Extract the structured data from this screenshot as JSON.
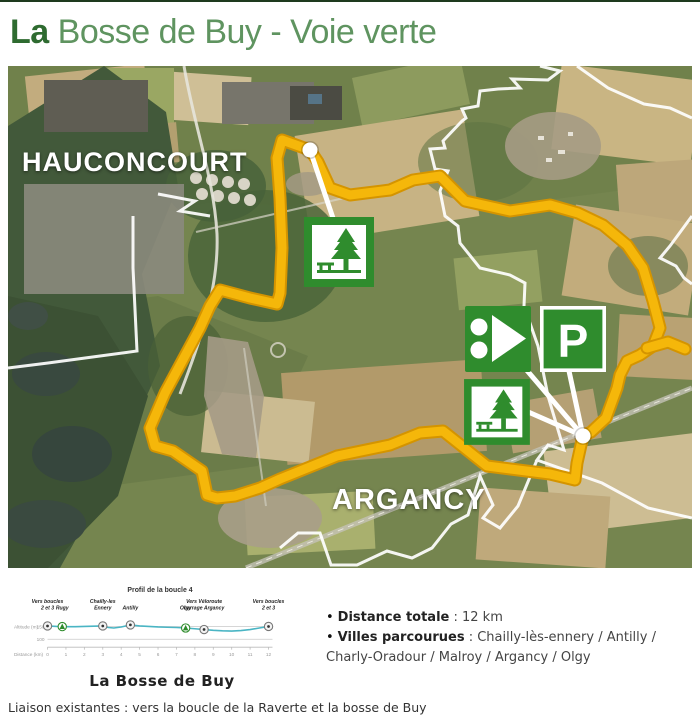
{
  "header": {
    "title_prefix": "La",
    "title_rest": "Bosse de Buy - Voie verte"
  },
  "map": {
    "place_labels": {
      "hauconcourt": "HAUCONCOURT",
      "argancy": "ARGANCY"
    },
    "icons": {
      "parking_label": "P"
    },
    "route": {
      "color": "#f5b70a",
      "casing_color": "#d49400",
      "points": [
        [
          302,
          84
        ],
        [
          310,
          96
        ],
        [
          322,
          122
        ],
        [
          342,
          129
        ],
        [
          382,
          124
        ],
        [
          405,
          114
        ],
        [
          432,
          110
        ],
        [
          457,
          135
        ],
        [
          502,
          145
        ],
        [
          542,
          139
        ],
        [
          570,
          147
        ],
        [
          595,
          159
        ],
        [
          619,
          179
        ],
        [
          635,
          202
        ],
        [
          645,
          235
        ],
        [
          652,
          262
        ],
        [
          645,
          280
        ],
        [
          632,
          289
        ],
        [
          619,
          295
        ],
        [
          612,
          309
        ],
        [
          609,
          322
        ],
        [
          598,
          352
        ],
        [
          583,
          366
        ],
        [
          575,
          370
        ],
        [
          569,
          397
        ],
        [
          567,
          414
        ],
        [
          542,
          408
        ],
        [
          479,
          400
        ],
        [
          435,
          365
        ],
        [
          412,
          367
        ],
        [
          382,
          379
        ],
        [
          329,
          390
        ],
        [
          272,
          413
        ],
        [
          252,
          422
        ],
        [
          227,
          430
        ],
        [
          209,
          432
        ],
        [
          199,
          429
        ],
        [
          194,
          405
        ],
        [
          165,
          385
        ],
        [
          147,
          380
        ],
        [
          142,
          362
        ],
        [
          157,
          327
        ],
        [
          192,
          262
        ],
        [
          202,
          240
        ],
        [
          212,
          224
        ],
        [
          242,
          232
        ],
        [
          269,
          238
        ],
        [
          272,
          227
        ],
        [
          274,
          182
        ],
        [
          272,
          132
        ],
        [
          269,
          92
        ],
        [
          274,
          74
        ],
        [
          302,
          84
        ]
      ],
      "branch": [
        [
          639,
          282
        ],
        [
          660,
          276
        ],
        [
          677,
          283
        ]
      ],
      "markers": [
        [
          302,
          84
        ],
        [
          575,
          370
        ]
      ],
      "leaders": [
        [
          [
            302,
            84
          ],
          [
            327,
            158
          ]
        ],
        [
          [
            575,
            370
          ],
          [
            516,
            301
          ]
        ],
        [
          [
            575,
            370
          ],
          [
            561,
            305
          ]
        ],
        [
          [
            575,
            370
          ],
          [
            518,
            345
          ]
        ]
      ]
    }
  },
  "chart_data": {
    "type": "line",
    "title": "Profil de la boucle 4",
    "caption": "La Bosse de Buy",
    "xlabel": "Distance (km)",
    "ylabel": "Altitude (m)",
    "xlim": [
      0,
      12
    ],
    "xticks": [
      0,
      1,
      2,
      3,
      4,
      5,
      6,
      7,
      8,
      9,
      10,
      11,
      12
    ],
    "yticks": [
      100,
      150
    ],
    "line_color": "#4ab5c4",
    "x": [
      0,
      0.5,
      1,
      1.5,
      2,
      2.5,
      3,
      3.3,
      3.6,
      4,
      4.5,
      5,
      5.5,
      6,
      6.5,
      7,
      7.5,
      8,
      8.5,
      9,
      9.5,
      10,
      10.5,
      11,
      11.5,
      12
    ],
    "y": [
      152,
      150,
      149,
      149,
      150,
      151,
      152,
      146,
      144,
      148,
      156,
      152,
      150,
      148,
      147,
      146,
      144,
      141,
      138,
      135,
      133,
      132,
      134,
      138,
      144,
      150
    ],
    "waypoints": [
      {
        "km": 0,
        "lines": [
          "Vers boucles",
          "2 et 3"
        ],
        "marker": "circle"
      },
      {
        "km": 0.8,
        "lines": [
          "Rugy"
        ],
        "marker": "tree"
      },
      {
        "km": 3,
        "lines": [
          "Chailly-les",
          "Ennery"
        ],
        "marker": "circle"
      },
      {
        "km": 4.5,
        "lines": [
          "Antilly"
        ],
        "marker": "circle"
      },
      {
        "km": 7.5,
        "lines": [
          "Olgy"
        ],
        "marker": "tree"
      },
      {
        "km": 8.5,
        "lines": [
          "Vers Véloroute",
          "barrage Argancy"
        ],
        "marker": "circle"
      },
      {
        "km": 12,
        "lines": [
          "Vers boucles",
          "2 et 3"
        ],
        "marker": "circle"
      }
    ]
  },
  "details": {
    "bullets": [
      {
        "label": "Distance totale",
        "value": " : 12 km"
      },
      {
        "label": "Villes parcourues",
        "value": " : Chailly-lès-ennery / Antilly / Charly-Oradour / Malroy / Argancy / Olgy"
      }
    ]
  },
  "footer": {
    "liaison": "Liaison existantes : vers la boucle de la Raverte et la bosse de Buy"
  }
}
